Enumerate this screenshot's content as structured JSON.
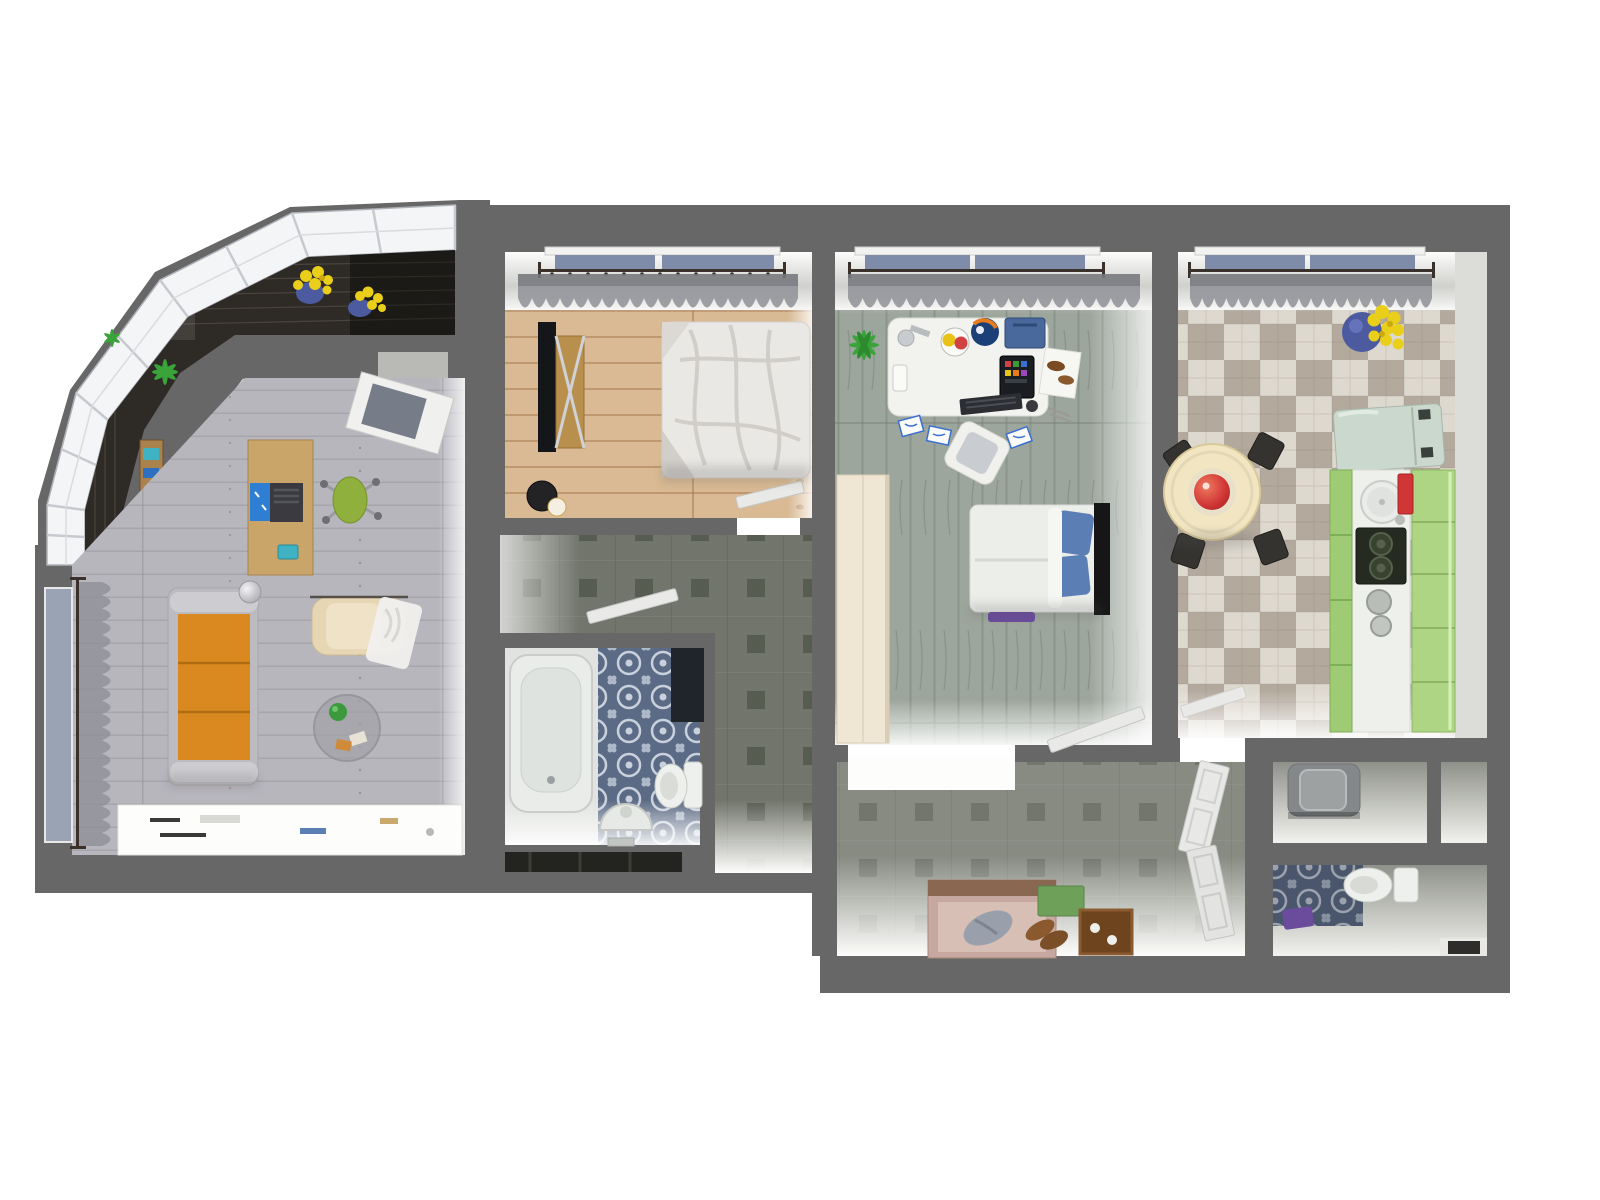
{
  "meta": {
    "title": "3D apartment floor plan render, top-down view",
    "view": "top-down 3d render",
    "visible_text": ""
  },
  "colors": {
    "page": "#ffffff",
    "wall": "#676767",
    "living_floor": "#b8b6bd",
    "pine_floor": "#d9ba94",
    "office_floor": "#9da69d",
    "kitchen_light": "#ded9cf",
    "kitchen_dark": "#b3a99d",
    "tile_base": "#71756b",
    "tile_dark": "#575c51",
    "bath_tile": "#5c6b85",
    "bath_ornament": "#c9d1dd",
    "balcony_floor": "#2e2a25",
    "glass": "#f4f5f7",
    "sofa_orange": "#d9891f",
    "armchair_cream": "#e6d6b4",
    "desk_wood": "#c9a56a",
    "chair_green": "#8fb03c",
    "duvet_white": "#eae8e5",
    "pillow_blue": "#5b7fb5",
    "fridge_mint": "#cbd8cd",
    "cabinet_green": "#9fcb74",
    "cabinet_green_light": "#aed584",
    "table_cream": "#f2e6c2",
    "bowl_red": "#cf3434",
    "door_white": "#e9e9e7",
    "mat_purple": "#6a4b9c",
    "bench_pink": "#c7a8a0",
    "box_green": "#6fa05a",
    "tray_brown": "#6e441f",
    "flower_yellow": "#e9cf1a",
    "pot_blue": "#4c5aa0",
    "plant_green": "#3aa43a",
    "curtain_gray": "#8e9097",
    "window_blue": "#7e8caa",
    "washer_gray": "#85888a",
    "rug_white": "#fdfdfb"
  },
  "rooms": {
    "balcony": {
      "label": "Glazed balcony",
      "items": [
        "panoramic-glazing",
        "dark-wood-floor",
        "yellow-flowers-in-blue-pots",
        "green-plant",
        "storage-shelf"
      ]
    },
    "living_room": {
      "label": "Living room",
      "items": [
        "orange-sofa",
        "cream-armchair",
        "white-throw",
        "glass-coffee-table",
        "white-rug",
        "wooden-desk",
        "laptop",
        "green-office-chair",
        "floor-lamp",
        "curtained-window",
        "open-door"
      ]
    },
    "bedroom": {
      "label": "Bedroom",
      "items": [
        "double-bed-rumpled-duvet",
        "tv-panel",
        "wooden-dresser",
        "black-stool",
        "lamp",
        "curtained-window",
        "open-door"
      ]
    },
    "study": {
      "label": "Study bedroom",
      "items": [
        "white-desk",
        "globe",
        "blue-crate",
        "tablet",
        "papers-with-blue-sketches",
        "tipped-white-chair",
        "cream-wardrobe",
        "bed-with-blue-pillows",
        "purple-mat",
        "green-plant",
        "curtained-window",
        "open-door"
      ]
    },
    "kitchen": {
      "label": "Kitchen",
      "items": [
        "checkered-tile-floor",
        "round-dining-table",
        "red-bowl",
        "dark-chairs",
        "mint-fridge",
        "green-cabinet-run",
        "round-sink",
        "red-cutting-board",
        "two-burner-stove",
        "pots",
        "yellow-flowers-in-blue-pot",
        "curtained-window",
        "open-door"
      ]
    },
    "corridor": {
      "label": "Corridor",
      "items": [
        "square-motif-tile",
        "open-bathroom-door"
      ]
    },
    "bathroom": {
      "label": "Bathroom",
      "items": [
        "bathtub",
        "pedestal-sink",
        "toilet",
        "ornamental-blue-tile",
        "dark-niche"
      ]
    },
    "hallway": {
      "label": "Entry hallway",
      "items": [
        "square-motif-tile",
        "bright-threshold",
        "shoe-bench",
        "gray-cloth",
        "brown-shoes",
        "green-box",
        "wooden-tray",
        "bifold-white-door"
      ]
    },
    "storage": {
      "label": "Storage closets",
      "items": [
        "washing-machine",
        "empty-closet"
      ]
    },
    "wc": {
      "label": "WC",
      "items": [
        "toilet",
        "purple-mat",
        "ornamental-blue-tile",
        "dark-mat-nook"
      ]
    }
  }
}
